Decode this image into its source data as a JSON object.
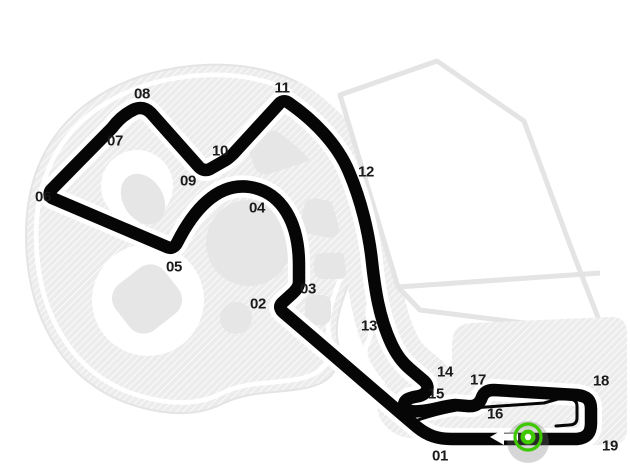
{
  "track_map": {
    "type": "circuit-map",
    "turns": [
      {
        "label": "01",
        "x": 440,
        "y": 456
      },
      {
        "label": "02",
        "x": 258,
        "y": 304
      },
      {
        "label": "03",
        "x": 308,
        "y": 289
      },
      {
        "label": "04",
        "x": 257,
        "y": 208
      },
      {
        "label": "05",
        "x": 174,
        "y": 267
      },
      {
        "label": "06",
        "x": 43,
        "y": 197
      },
      {
        "label": "07",
        "x": 115,
        "y": 141
      },
      {
        "label": "08",
        "x": 142,
        "y": 94
      },
      {
        "label": "09",
        "x": 188,
        "y": 181
      },
      {
        "label": "10",
        "x": 220,
        "y": 151
      },
      {
        "label": "11",
        "x": 282,
        "y": 88
      },
      {
        "label": "12",
        "x": 366,
        "y": 172
      },
      {
        "label": "13",
        "x": 369,
        "y": 326
      },
      {
        "label": "14",
        "x": 445,
        "y": 372
      },
      {
        "label": "15",
        "x": 436,
        "y": 394
      },
      {
        "label": "16",
        "x": 495,
        "y": 414
      },
      {
        "label": "17",
        "x": 478,
        "y": 380
      },
      {
        "label": "18",
        "x": 601,
        "y": 381
      },
      {
        "label": "19",
        "x": 610,
        "y": 446
      }
    ],
    "start_marker": {
      "icon": "start-finish-marker",
      "arrow_icon": "direction-arrow-left",
      "direction": "left",
      "x": 528,
      "y": 437
    },
    "colors": {
      "track": "#060606",
      "track-casing": "#ffffff",
      "shape-fill": "#ececec",
      "shape-stroke": "#e4e4e4",
      "blob-fill": "#e6e6e6",
      "hatch-line": "#ffffff",
      "marker-green": "#3ec800",
      "label-text": "#1a1a1a"
    }
  }
}
